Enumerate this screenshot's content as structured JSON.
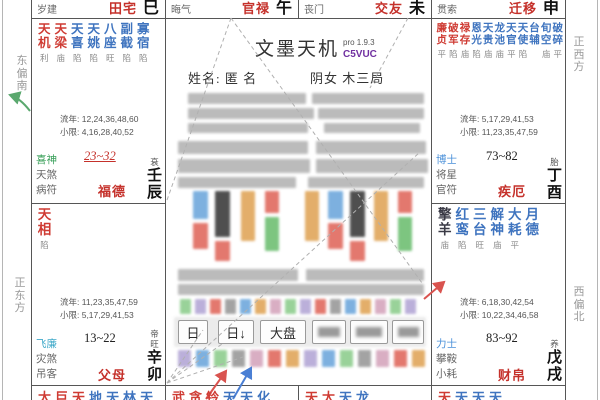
{
  "app": {
    "title": "文墨天机",
    "version": "pro 1.9.3",
    "code": "C5VUC"
  },
  "person": {
    "name_line": "姓名: 匿 名",
    "gender_bureau": "阴女 木三局"
  },
  "toolbar": {
    "buttons": [
      "日",
      "日↓",
      "大盘"
    ],
    "blurred_button_count": 3
  },
  "compass": {
    "left_top": "东偏南",
    "left_bottom": "正东方",
    "right_top": "正西方",
    "right_bottom": "西偏北"
  },
  "colors": {
    "main_star": "#cf3b33",
    "aux_star": "#3f74bf",
    "dark_star": "#3a3a46",
    "palace_red": "#c5312b",
    "god_green": "#3aa05a",
    "god_cyan": "#3fa9c9",
    "god_blue": "#4a90d9",
    "accent_purple": "#7030a0",
    "arrow_red": "#d9534f",
    "arrow_blue": "#4a7fd4",
    "arrow_green": "#5aa86e"
  },
  "top_cells": [
    {
      "god": "岁建",
      "palace": "田宅",
      "branch": "巳"
    },
    {
      "god": "晦气",
      "palace": "官禄",
      "branch": "午"
    },
    {
      "god": "丧门",
      "palace": "交友",
      "branch": "未"
    },
    {
      "god": "贯索",
      "palace": "迁移",
      "branch": "申"
    }
  ],
  "side_cells": [
    {
      "id": "chen",
      "pos": "left-top",
      "stars": [
        {
          "n": "天机",
          "s": "利",
          "c": "r"
        },
        {
          "n": "天梁",
          "s": "庙",
          "c": "r"
        },
        {
          "n": "天喜",
          "s": "陷",
          "c": "b"
        },
        {
          "n": "天姚",
          "s": "陷",
          "c": "b"
        },
        {
          "n": "八座",
          "s": "旺",
          "c": "b"
        },
        {
          "n": "副截",
          "s": "陷",
          "c": "b"
        },
        {
          "n": "寡宿",
          "s": "陷",
          "c": "b"
        }
      ],
      "liunian": "流年: 12,24,36,48,60",
      "xiaoxian": "小限: 4,16,28,40,52",
      "gods": [
        {
          "t": "喜神",
          "c": "green"
        },
        {
          "t": "天煞",
          "c": "gray"
        },
        {
          "t": "病符",
          "c": "gray"
        }
      ],
      "age_range": "23~32",
      "age_style": "red-underline",
      "palace": "福德",
      "stage": "衰",
      "stem_branch": "壬辰"
    },
    {
      "id": "mao",
      "pos": "left-bottom",
      "stars": [
        {
          "n": "天相",
          "s": "陷",
          "c": "r"
        }
      ],
      "liunian": "流年: 11,23,35,47,59",
      "xiaoxian": "小限: 5,17,29,41,53",
      "gods": [
        {
          "t": "飞廉",
          "c": "cyan"
        },
        {
          "t": "灾煞",
          "c": "gray"
        },
        {
          "t": "吊客",
          "c": "gray"
        }
      ],
      "age_range": "13~22",
      "age_style": "plain",
      "palace": "父母",
      "stage": "帝旺",
      "stem_branch": "辛卯"
    },
    {
      "id": "you",
      "pos": "right-top",
      "stars": [
        {
          "n": "廉贞",
          "s": "平",
          "c": "r"
        },
        {
          "n": "破军",
          "s": "陷",
          "c": "r"
        },
        {
          "n": "禄存",
          "s": "庙",
          "c": "r"
        },
        {
          "n": "恩光",
          "s": "陷",
          "c": "b"
        },
        {
          "n": "天贵",
          "s": "庙",
          "c": "b"
        },
        {
          "n": "龙池",
          "s": "庙",
          "c": "b"
        },
        {
          "n": "天官",
          "s": "平",
          "c": "b"
        },
        {
          "n": "天使",
          "s": "陷",
          "c": "b"
        },
        {
          "n": "台辅",
          "s": "",
          "c": "b"
        },
        {
          "n": "旬空",
          "s": "庙",
          "c": "b"
        },
        {
          "n": "破碎",
          "s": "平",
          "c": "b"
        }
      ],
      "liunian": "流年: 5,17,29,41,53",
      "xiaoxian": "小限: 11,23,35,47,59",
      "gods": [
        {
          "t": "博士",
          "c": "blue"
        },
        {
          "t": "将星",
          "c": "gray"
        },
        {
          "t": "官符",
          "c": "gray"
        }
      ],
      "age_range": "73~82",
      "age_style": "plain",
      "palace": "疾厄",
      "stage": "胎",
      "stem_branch": "丁酉"
    },
    {
      "id": "xu",
      "pos": "right-bottom",
      "stars": [
        {
          "n": "擎羊",
          "s": "庙",
          "c": "k"
        },
        {
          "n": "红鸾",
          "s": "陷",
          "c": "b"
        },
        {
          "n": "三台",
          "s": "旺",
          "c": "b"
        },
        {
          "n": "解神",
          "s": "庙",
          "c": "b"
        },
        {
          "n": "大耗",
          "s": "平",
          "c": "b"
        },
        {
          "n": "月德",
          "s": "",
          "c": "b"
        }
      ],
      "liunian": "流年: 6,18,30,42,54",
      "xiaoxian": "小限: 10,22,34,46,58",
      "gods": [
        {
          "t": "力士",
          "c": "blue"
        },
        {
          "t": "攀鞍",
          "c": "gray"
        },
        {
          "t": "小耗",
          "c": "gray"
        }
      ],
      "age_range": "83~92",
      "age_style": "plain",
      "palace": "财帛",
      "stage": "养",
      "stem_branch": "戊戌"
    }
  ],
  "bottom_cells": [
    {
      "branch": "寅",
      "chars": [
        [
          "太",
          "r"
        ],
        [
          "巨",
          "r"
        ],
        [
          "天",
          "r"
        ],
        [
          "地",
          "b"
        ],
        [
          "天",
          "b"
        ],
        [
          "林",
          "b"
        ],
        [
          "天",
          "b"
        ]
      ]
    },
    {
      "branch": "丑",
      "chars": [
        [
          "武",
          "r"
        ],
        [
          "贪",
          "r"
        ],
        [
          "铃",
          "r"
        ],
        [
          "天",
          "b"
        ],
        [
          "天",
          "b"
        ],
        [
          "化",
          "b"
        ]
      ]
    },
    {
      "branch": "子",
      "chars": [
        [
          "天",
          "r"
        ],
        [
          "太",
          "r"
        ],
        [
          "天",
          "b"
        ],
        [
          "龙",
          "b"
        ]
      ]
    },
    {
      "branch": "亥",
      "chars": [
        [
          "天",
          "r"
        ],
        [
          "天",
          "b"
        ],
        [
          "天",
          "b"
        ],
        [
          "天",
          "b"
        ]
      ]
    }
  ]
}
